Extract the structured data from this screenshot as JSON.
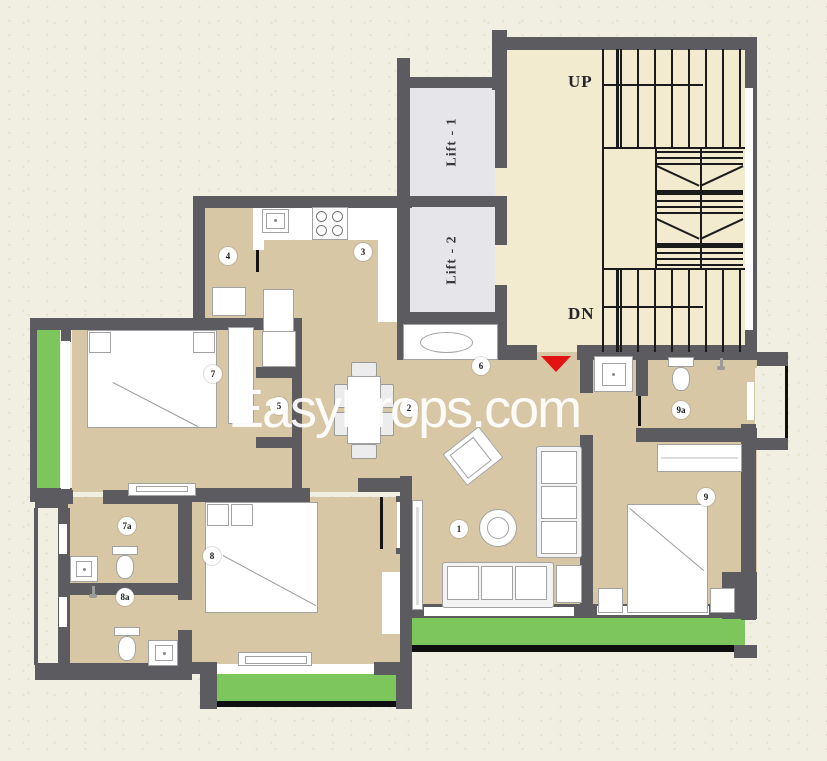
{
  "watermark_text": "EasyProps.com",
  "staircase": {
    "up_label": "UP",
    "down_label": "DN"
  },
  "lifts": {
    "lift1_label": "Lift - 1",
    "lift2_label": "Lift - 2"
  },
  "rooms": [
    {
      "id": "living-room",
      "label": "1"
    },
    {
      "id": "dining",
      "label": "2"
    },
    {
      "id": "kitchen",
      "label": "3"
    },
    {
      "id": "store",
      "label": "4"
    },
    {
      "id": "dressing",
      "label": "5"
    },
    {
      "id": "foyer-wash",
      "label": "6"
    },
    {
      "id": "bedroom-7",
      "label": "7"
    },
    {
      "id": "toilet-7a",
      "label": "7a"
    },
    {
      "id": "bedroom-8",
      "label": "8"
    },
    {
      "id": "toilet-8a",
      "label": "8a"
    },
    {
      "id": "bedroom-9",
      "label": "9"
    },
    {
      "id": "toilet-9a",
      "label": "9a"
    }
  ],
  "colors": {
    "background": "#f1eee2",
    "wall": "#5b5b60",
    "floor": "#d8c7a5",
    "stair_lobby": "#f2ebcf",
    "lift": "#e6e6ea",
    "balcony": "#7cc65c",
    "entrance_marker": "#e31313",
    "stair_lines": "#161616",
    "watermark": "#ffffff"
  }
}
